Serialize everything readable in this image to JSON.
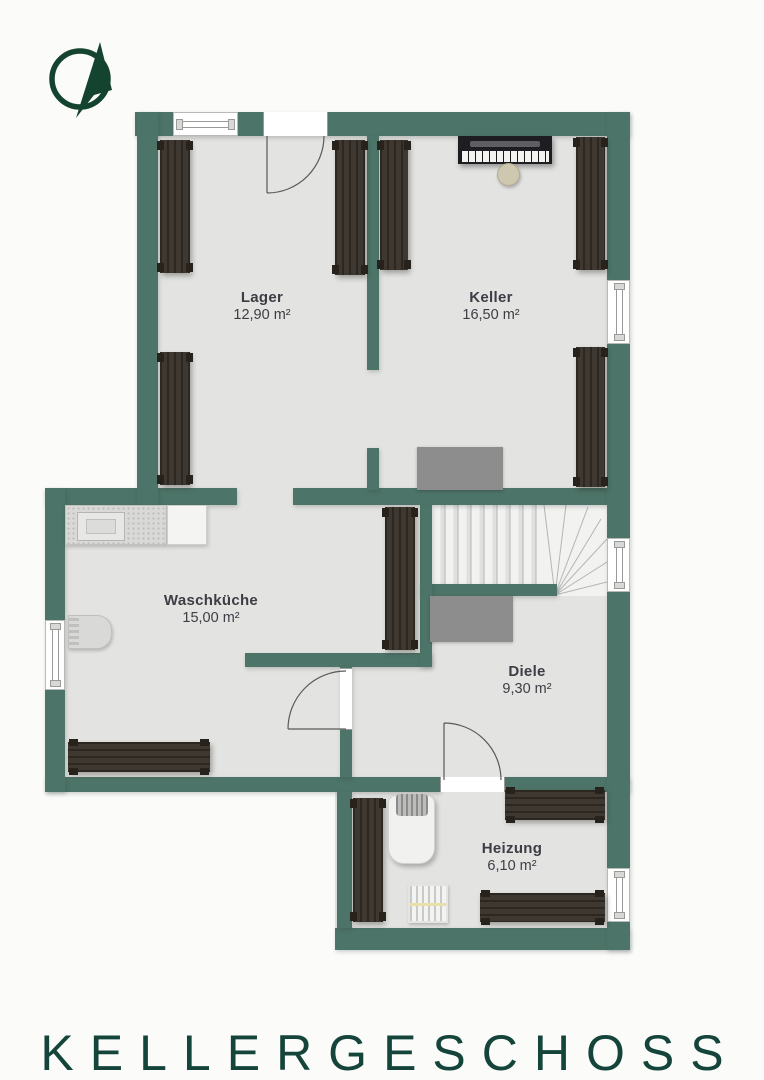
{
  "title": "KELLERGESCHOSS",
  "compass": {
    "icon": "compass-north-arrow-icon"
  },
  "rooms": [
    {
      "id": "lager",
      "name": "Lager",
      "area": "12,90 m²"
    },
    {
      "id": "keller",
      "name": "Keller",
      "area": "16,50 m²"
    },
    {
      "id": "waschkueche",
      "name": "Waschküche",
      "area": "15,00 m²"
    },
    {
      "id": "diele",
      "name": "Diele",
      "area": "9,30 m²"
    },
    {
      "id": "heizung",
      "name": "Heizung",
      "area": "6,10 m²"
    }
  ],
  "colors": {
    "wall": "#4d7468",
    "accent_dark_green": "#15443a",
    "floor": "#e3e3e1",
    "wood_shelf": "#38322a",
    "label_text": "#3d3d45",
    "stair_block_gray": "#8d8d8d"
  }
}
